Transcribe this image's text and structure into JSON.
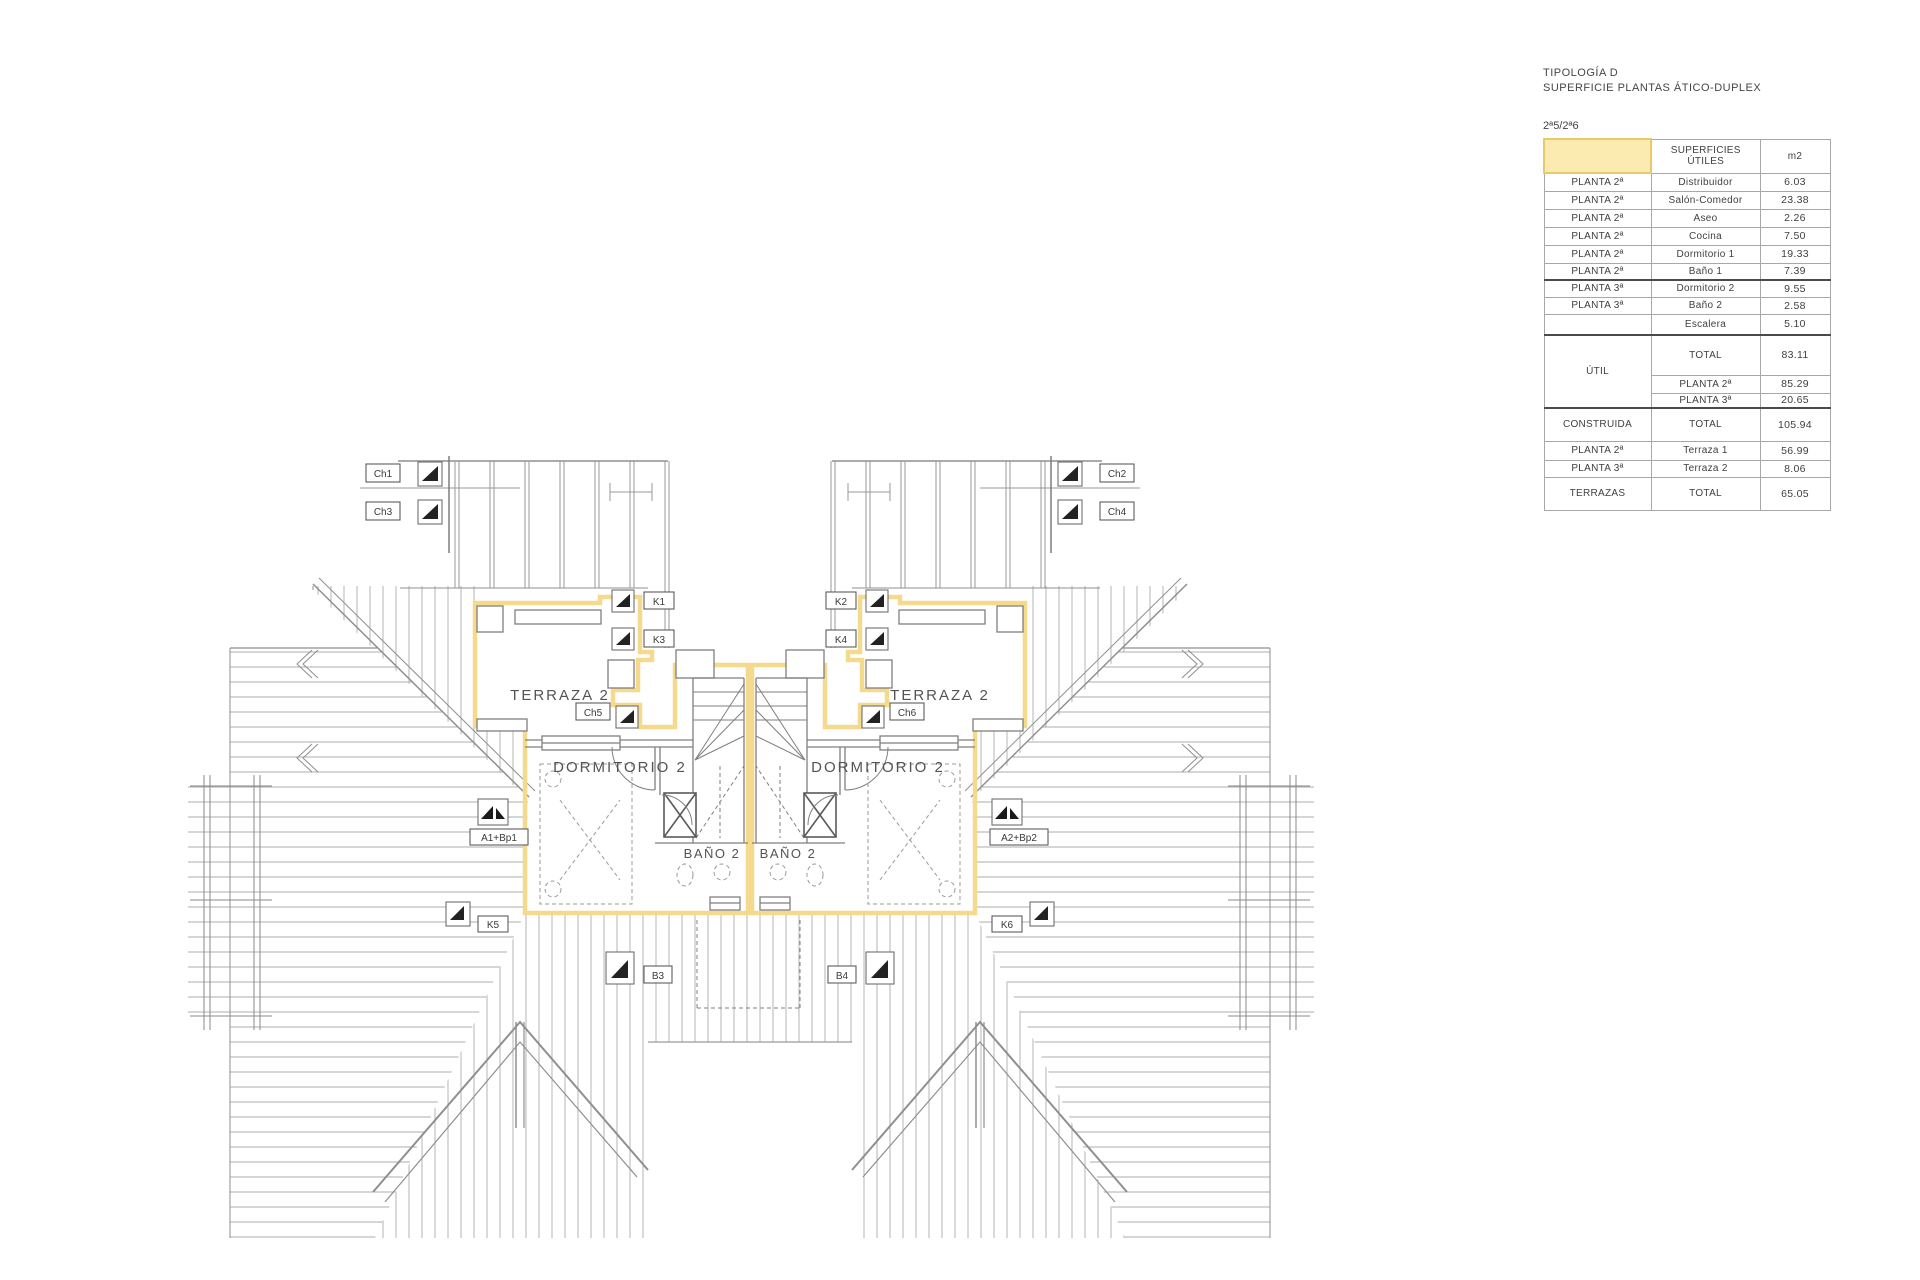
{
  "panel": {
    "title_line1": "TIPOLOGÍA D",
    "title_line2": "SUPERFICIE PLANTAS ÁTICO-DUPLEX",
    "subtitle": "2ª5/2ª6",
    "header": {
      "col2a": "SUPERFICIES",
      "col2b": "ÚTILES",
      "col3": "m2"
    },
    "rows": [
      {
        "planta": "PLANTA 2ª",
        "concepto": "Distribuidor",
        "m2": "6.03"
      },
      {
        "planta": "PLANTA 2ª",
        "concepto": "Salón-Comedor",
        "m2": "23.38"
      },
      {
        "planta": "PLANTA 2ª",
        "concepto": "Aseo",
        "m2": "2.26"
      },
      {
        "planta": "PLANTA 2ª",
        "concepto": "Cocina",
        "m2": "7.50"
      },
      {
        "planta": "PLANTA 2ª",
        "concepto": "Dormitorio 1",
        "m2": "19.33"
      },
      {
        "planta": "PLANTA 2ª",
        "concepto": "Baño 1",
        "m2": "7.39"
      },
      {
        "planta": "PLANTA 3ª",
        "concepto": "Dormitorio 2",
        "m2": "9.55"
      },
      {
        "planta": "PLANTA 3ª",
        "concepto": "Baño 2",
        "m2": "2.58"
      },
      {
        "planta": "",
        "concepto": "Escalera",
        "m2": "5.10"
      },
      {
        "planta": "ÚTIL",
        "concepto": "TOTAL",
        "m2": "83.11"
      },
      {
        "planta": "",
        "concepto": "PLANTA 2ª",
        "m2": "85.29"
      },
      {
        "planta": "",
        "concepto": "PLANTA 3ª",
        "m2": "20.65"
      },
      {
        "planta": "CONSTRUIDA",
        "concepto": "TOTAL",
        "m2": "105.94"
      },
      {
        "planta": "PLANTA 2ª",
        "concepto": "Terraza 1",
        "m2": "56.99"
      },
      {
        "planta": "PLANTA 3ª",
        "concepto": "Terraza 2",
        "m2": "8.06"
      },
      {
        "planta": "TERRAZAS",
        "concepto": "TOTAL",
        "m2": "65.05"
      }
    ]
  },
  "plan": {
    "rooms": {
      "terraza": "TERRAZA 2",
      "dormitorio": "DORMITORIO 2",
      "bano": "BAÑO 2"
    },
    "tags": {
      "ch1": "Ch1",
      "ch2": "Ch2",
      "ch3": "Ch3",
      "ch4": "Ch4",
      "ch5": "Ch5",
      "ch6": "Ch6",
      "k1": "K1",
      "k2": "K2",
      "k3": "K3",
      "k4": "K4",
      "k5": "K5",
      "k6": "K6",
      "b3": "B3",
      "b4": "B4",
      "a1": "A1+Bp1",
      "a2": "A2+Bp2"
    },
    "colors": {
      "unit_outline": "#F5D98C",
      "legend_cell_fill": "#FCEBB0",
      "legend_cell_border": "#E9C968",
      "wall_gray": "#7f7f7f",
      "hatch_gray": "#b4b4b4"
    },
    "icons": {
      "marker": "triangle-marker-icon",
      "awning": "double-triangle-marker-icon"
    }
  }
}
